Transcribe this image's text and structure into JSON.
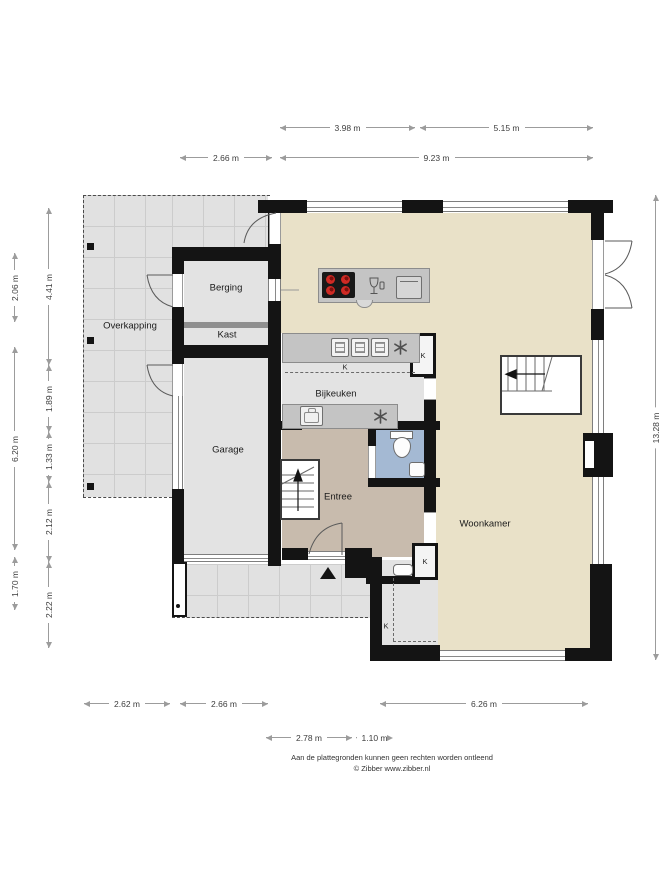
{
  "rooms": {
    "overkapping": "Overkapping",
    "berging": "Berging",
    "kast": "Kast",
    "garage": "Garage",
    "bijkeuken": "Bijkeuken",
    "entree": "Entree",
    "woonkamer": "Woonkamer",
    "closet_abbr": "K"
  },
  "dimensions": {
    "top": [
      "3.98 m",
      "5.15 m",
      "2.66 m",
      "9.23 m"
    ],
    "left_outer": [
      "2.06 m",
      "6.20 m",
      "1.70 m"
    ],
    "left_inner": [
      "4.41 m",
      "1.89 m",
      "1.33 m",
      "2.12 m",
      "2.22 m"
    ],
    "right": [
      "13.28 m"
    ],
    "bottom_outer": [
      "2.62 m",
      "2.66 m",
      "6.26 m"
    ],
    "bottom_inner": [
      "2.78 m",
      "1.10 m"
    ]
  },
  "footer": {
    "line1": "Aan de plattegronden kunnen geen rechten worden ontleend",
    "line2": "© Zibber www.zibber.nl"
  },
  "icons": {
    "entrance_marker": "triangle-up",
    "extractor_fan": "six-spoke-fan",
    "cooktop": "4-burner-hob",
    "dishwasher": "glassware",
    "stair_direction": "arrow"
  },
  "colors": {
    "wall": "#141414",
    "floor_living": "#e9e1c8",
    "floor_hall": "#c8bbad",
    "floor_toilet": "#a4b9d3",
    "floor_outdoor": "#e1e1e1",
    "counter": "#c4c4c4",
    "burner_red": "#cf2a24"
  }
}
